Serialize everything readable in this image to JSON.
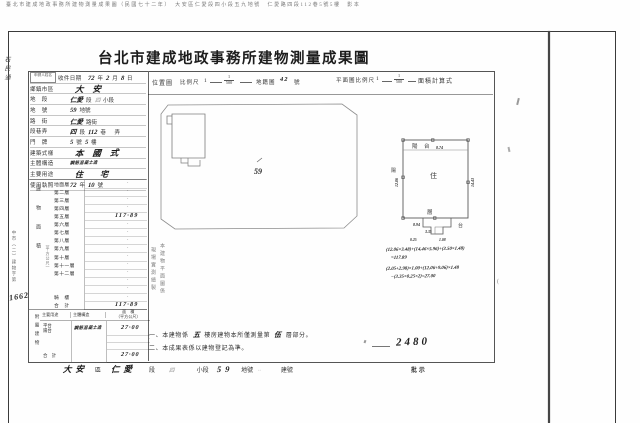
{
  "caption": "臺北市建成地政事務所建物測量成果圖（民國七十二年）　大安區仁愛段四小段五九地號　仁愛路四段112巷5號5樓　影本",
  "title": "台北市建成地政事務所建物測量成果圖",
  "margin_hand": "石民通",
  "form": {
    "applicant_box": "申請人姓名",
    "rows": [
      {
        "label": "收件日期",
        "box": true,
        "parts": [
          [
            "h",
            "72"
          ],
          [
            "p",
            "年"
          ],
          [
            "h",
            "2"
          ],
          [
            "p",
            "月"
          ],
          [
            "h",
            "8"
          ],
          [
            "p",
            "日"
          ]
        ]
      },
      {
        "label": "鄉鎮市區",
        "parts": [
          [
            "hL",
            "大安"
          ]
        ]
      },
      {
        "label": "地　段",
        "parts": [
          [
            "h",
            "仁愛"
          ],
          [
            "p",
            "段"
          ],
          [
            "hf",
            "四"
          ],
          [
            "p",
            "小段"
          ]
        ]
      },
      {
        "label": "地　號",
        "parts": [
          [
            "h",
            "59"
          ],
          [
            "p",
            "地號"
          ]
        ]
      },
      {
        "label": "路　街",
        "parts": [
          [
            "h",
            "仁愛"
          ],
          [
            "p",
            "路街"
          ]
        ]
      },
      {
        "label": "段巷弄",
        "parts": [
          [
            "h",
            "四"
          ],
          [
            "p",
            "段"
          ],
          [
            "h",
            "112"
          ],
          [
            "p",
            "巷"
          ],
          [
            "p",
            "　弄"
          ]
        ]
      },
      {
        "label": "門　牌",
        "parts": [
          [
            "h",
            "5"
          ],
          [
            "p",
            "號"
          ],
          [
            "h",
            "5"
          ],
          [
            "p",
            "樓"
          ]
        ]
      },
      {
        "label": "建築式樣",
        "parts": [
          [
            "hL",
            "本國式"
          ]
        ]
      },
      {
        "label": "主體構造",
        "parts": [
          [
            "hs",
            "鋼筋混凝土造"
          ]
        ]
      },
      {
        "label": "主要用途",
        "parts": [
          [
            "hW",
            "住宅"
          ]
        ]
      },
      {
        "label": "使用執照",
        "parts": [
          [
            "h",
            "72"
          ],
          [
            "p",
            "年"
          ],
          [
            "h",
            "10"
          ],
          [
            "p",
            "號"
          ]
        ]
      }
    ]
  },
  "floors": {
    "group_label": "建物面積",
    "unit_label": "（平方公尺）",
    "rows": [
      {
        "label": "地面層",
        "value": "·"
      },
      {
        "label": "第二層",
        "value": "·"
      },
      {
        "label": "第三層",
        "value": "·"
      },
      {
        "label": "第四層",
        "value": "·"
      },
      {
        "label": "第五層",
        "value": "117·89",
        "hand": true
      },
      {
        "label": "第六層",
        "value": "·"
      },
      {
        "label": "第七層",
        "value": "·"
      },
      {
        "label": "第八層",
        "value": "·"
      },
      {
        "label": "第九層",
        "value": "·"
      },
      {
        "label": "第十層",
        "value": "·"
      },
      {
        "label": "第十一層",
        "value": "·"
      },
      {
        "label": "第十二層",
        "value": "·"
      },
      {
        "label": "",
        "value": "·"
      },
      {
        "label": "",
        "value": "·"
      },
      {
        "label": "騎　樓",
        "value": "·"
      },
      {
        "label": "合　計",
        "value": "117·89",
        "hand": true
      }
    ]
  },
  "case_note": {
    "printed": "中市（二）建物字第",
    "hand": "1662"
  },
  "attached": {
    "group_label": "附屬建物",
    "headers": {
      "use": "主要用途",
      "structure": "主體構造",
      "area": "面　積",
      "area_unit": "（平方公尺）"
    },
    "rows": [
      {
        "use": "平台",
        "use2": "陽台",
        "structure": "鋼筋混凝土造",
        "value": "27·00",
        "hand": true,
        "tall": true
      },
      {
        "use": "",
        "use2": "",
        "structure": "",
        "value": "·"
      },
      {
        "use": "",
        "use2": "",
        "structure": "",
        "value": "·"
      },
      {
        "use": "合　計",
        "use2": "",
        "structure": "",
        "value": "27·00",
        "hand": true,
        "tall": true
      }
    ]
  },
  "location_map": {
    "label": "位置圖",
    "scale_label": "比例尺",
    "scale_num": "1",
    "scale_den": "500",
    "cadastre_label": "地籍圖",
    "cadastre_no": "42",
    "cadastre_suffix": "號",
    "parcel_no": "59"
  },
  "floor_plan": {
    "scale_label": "平面圖比例尺",
    "scale_num": "1",
    "scale_den": "500",
    "calc_label": "面積計算式",
    "labels": {
      "top_left": "陽",
      "top_right": "台",
      "side": "陽",
      "center": "住",
      "bottom": "層",
      "annex": "台"
    },
    "dims": {
      "top": "8.74",
      "left": "12.06",
      "right": "14.43",
      "bottom": "8.94",
      "annex_w": "3.35",
      "annex_h": "1.08",
      "annex_d": "0.25"
    },
    "calc_lines": [
      "(12.06×3.48)+(14.46×5.96)+(3.50×1.48)",
      "=117.89",
      "(2.05+2.98)×1.00+(12.06+9.06)×1.48",
      "−(3.35×0.25×2)=27.00"
    ]
  },
  "vertical_note": [
    "本建物平面圖係",
    "現場實測繪製"
  ],
  "notes": [
    {
      "parts": [
        [
          "p",
          "一、本建物係"
        ],
        [
          "h",
          "五"
        ],
        [
          "p",
          "樓房建物本所僅測量第"
        ],
        [
          "h",
          "伍"
        ],
        [
          "p",
          "層部分。"
        ]
      ]
    },
    {
      "parts": [
        [
          "p",
          "二、本成果表係以建物登記為準。"
        ]
      ]
    }
  ],
  "stamp_number": "2480",
  "bottom_strip": [
    [
      "h",
      "大安"
    ],
    [
      "p",
      "區"
    ],
    [
      "h",
      "仁愛"
    ],
    [
      "p",
      "段"
    ],
    [
      "hf",
      "四"
    ],
    [
      "p",
      "小段"
    ],
    [
      "h",
      "59"
    ],
    [
      "p",
      "地號"
    ],
    [
      "hf",
      "··"
    ],
    [
      "p",
      "建號"
    ],
    [
      "p",
      "批示"
    ]
  ]
}
